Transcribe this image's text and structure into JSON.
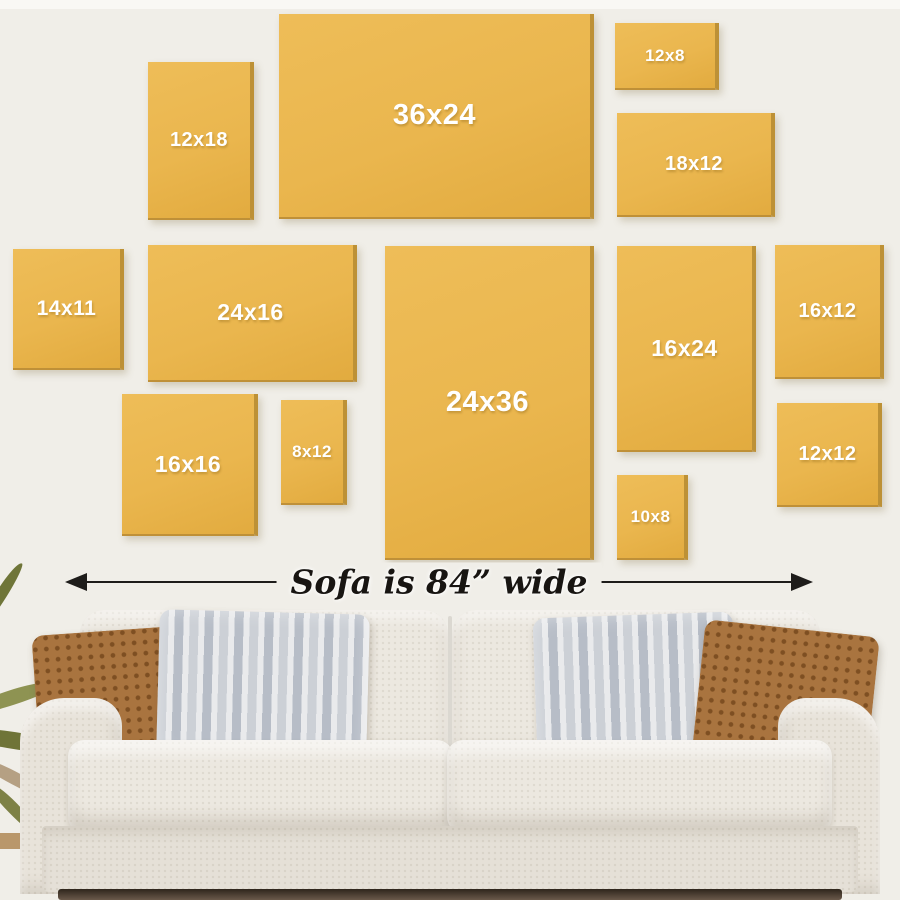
{
  "wall_frames": [
    {
      "label": "12x18",
      "x": 148,
      "y": 62,
      "w": 102,
      "h": 156
    },
    {
      "label": "36x24",
      "x": 279,
      "y": 14,
      "w": 311,
      "h": 203
    },
    {
      "label": "12x8",
      "x": 615,
      "y": 23,
      "w": 100,
      "h": 65
    },
    {
      "label": "18x12",
      "x": 617,
      "y": 113,
      "w": 154,
      "h": 102
    },
    {
      "label": "14x11",
      "x": 13,
      "y": 249,
      "w": 107,
      "h": 119
    },
    {
      "label": "24x16",
      "x": 148,
      "y": 245,
      "w": 205,
      "h": 135
    },
    {
      "label": "24x36",
      "x": 385,
      "y": 246,
      "w": 205,
      "h": 312
    },
    {
      "label": "16x24",
      "x": 617,
      "y": 246,
      "w": 135,
      "h": 204
    },
    {
      "label": "16x12",
      "x": 775,
      "y": 245,
      "w": 105,
      "h": 132
    },
    {
      "label": "16x16",
      "x": 122,
      "y": 394,
      "w": 132,
      "h": 140
    },
    {
      "label": "8x12",
      "x": 281,
      "y": 400,
      "w": 62,
      "h": 103
    },
    {
      "label": "10x8",
      "x": 617,
      "y": 475,
      "w": 67,
      "h": 83
    },
    {
      "label": "12x12",
      "x": 777,
      "y": 403,
      "w": 101,
      "h": 102
    }
  ],
  "sofa": {
    "width_label": "Sofa is 84” wide"
  },
  "colors": {
    "canvas": "#eab64e",
    "canvas_edge": "#bd9136",
    "wall": "#f0eee8",
    "arrow": "#1e1c1a",
    "sofa_fabric": "#e8e3da",
    "pillow_rust": "#a9743f",
    "pillow_grey_a": "#ccd0d6",
    "label_text": "#ffffff"
  }
}
